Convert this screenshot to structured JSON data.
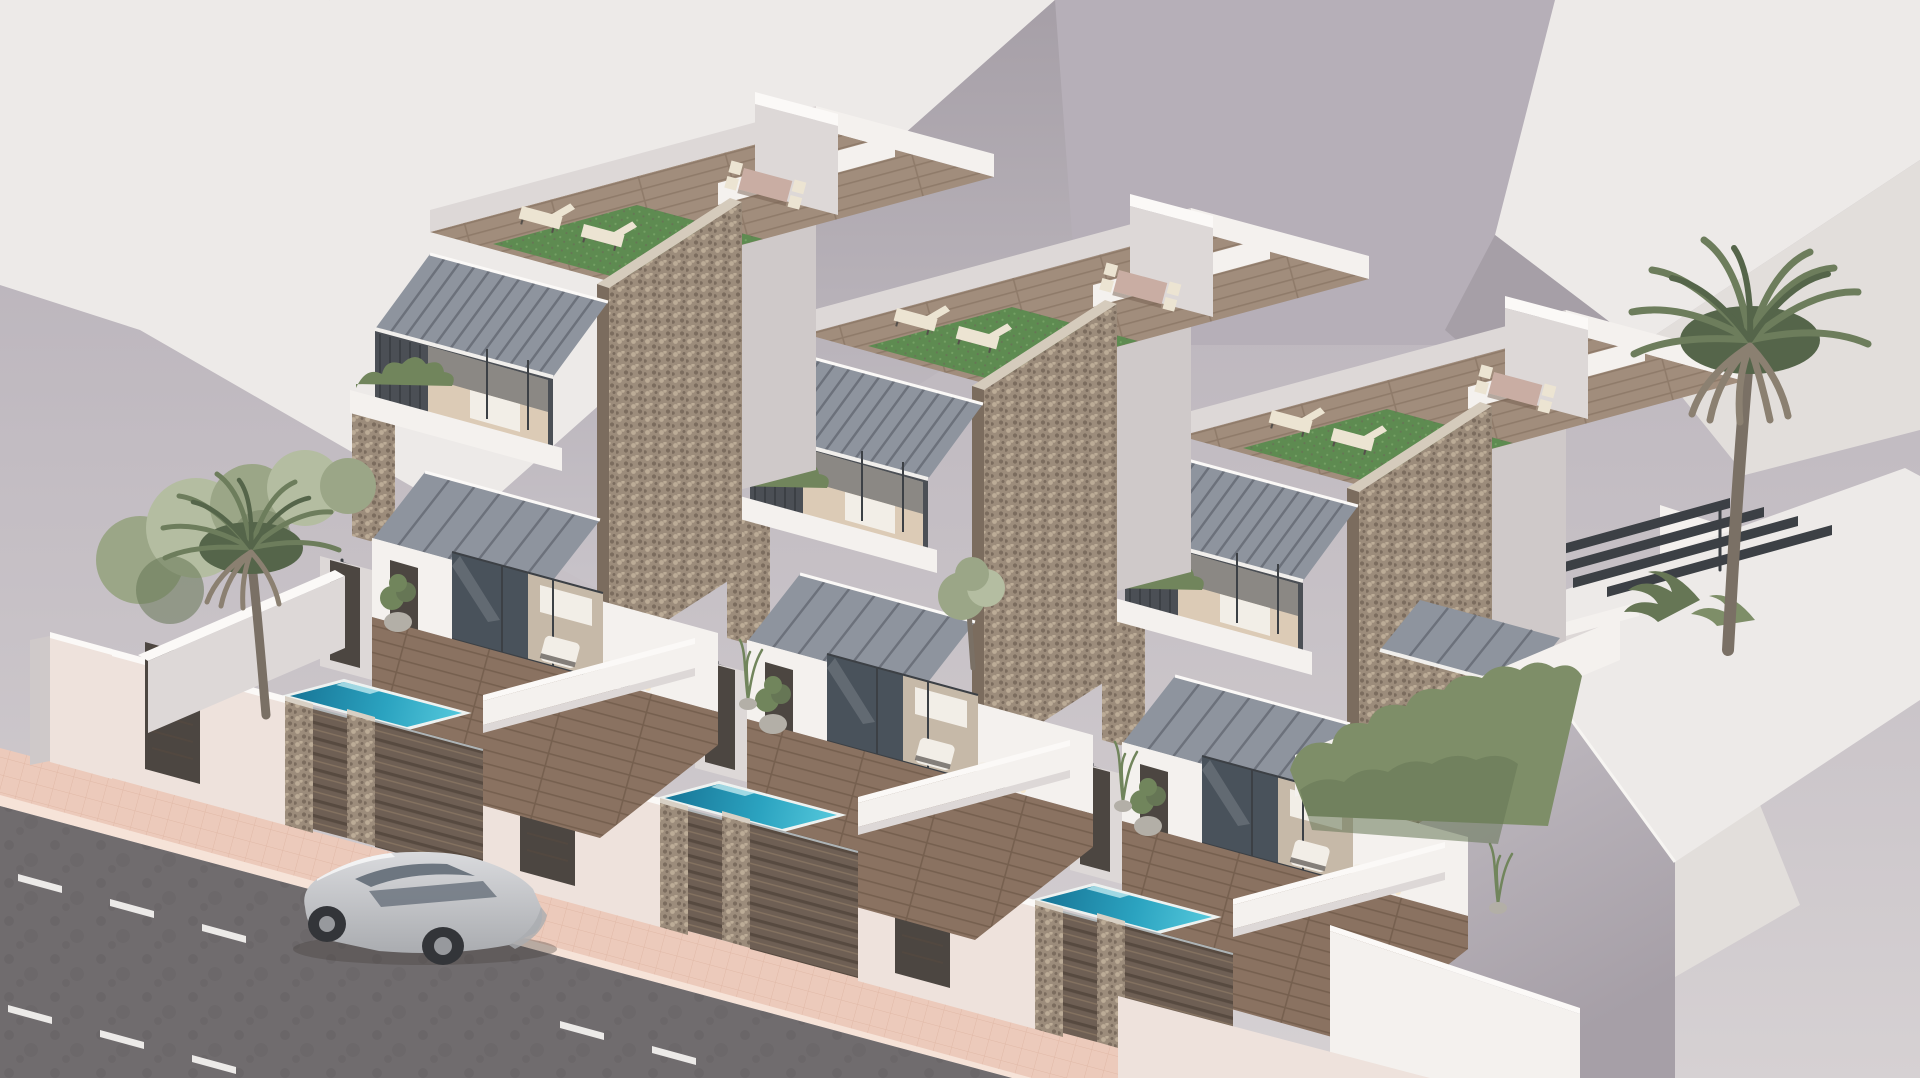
{
  "page": {
    "title": "Architectural 3D render — terrace of three modern villas with private pools"
  },
  "scene": {
    "type": "photorealistic exterior rendering",
    "view": "high-angle three-quarter aerial view",
    "lighting": "soft warm daylight",
    "villas": {
      "count": 3,
      "features": [
        "rooftop solarium with wooden deck and artificial turf",
        "two cream sun loungers per roof",
        "outdoor dining table with four wooden chairs",
        "white stepped parapets and stair bulkhead",
        "gray tiled mono-pitch roofs and door awnings",
        "full-height stone-clad corner pier",
        "recessed balcony with planter and dark glazing",
        "ground floor glass sliding doors with interior glimpse",
        "wooden deck terrace with two white armchairs",
        "turquoise plunge pool with steps",
        "outdoor shower column and potted plants",
        "front fence of dark wood slats between stone pillars",
        "white perimeter walls with dark access gates"
      ]
    },
    "street": {
      "road": "dark asphalt, two dashed white lane lines",
      "sidewalk": "salmon-pink paved tiles with light curb",
      "vehicle": "silver SUV driving along the street"
    },
    "vegetation": [
      "palm tree beside villa one",
      "leafy shrub row behind left boundary wall",
      "tall palm tree at right garden",
      "hedge along right side path",
      "banana plants in right patio",
      "potted olive trees and slim plants"
    ],
    "surroundings": [
      "abstract light-gray neighbouring building masses",
      "large white building block in right foreground",
      "pergola beams and outdoor steps at right villa",
      "white planter walls at lower right"
    ]
  },
  "palette": {
    "bgTop": "#b4adb6",
    "bgBot": "#d6d1d3",
    "bgLightFace": "#edeae8",
    "bgLightFace2": "#e2dedb",
    "bgGrayFace": "#a69fa7",
    "bgGrayFace2": "#b6afb8",
    "bgGrayFace3": "#c8c3c9",
    "white": "#f4f1ee",
    "whiteShade": "#ddd8d7",
    "whiteDim": "#cfc9c9",
    "whitePink": "#eee2dc",
    "cap": "#fbf9f7",
    "recess": "#4b4f55",
    "slatDark": "#3c4045",
    "glass": "#49525b",
    "glassHi": "#8fa0a8",
    "interior": "#dccbb6",
    "interiorFloor": "#b59878",
    "bed": "#f2eee7",
    "stone": "#9c8c7b",
    "stoneHi": "#bcac97",
    "stoneLo": "#7b6c5e",
    "stoneCap": "#d5cbbc",
    "tile": "#8e949e",
    "tileDark": "#6c717b",
    "fascia": "#f1efec",
    "woodRoof": "#a18d7c",
    "woodRoofLine": "#8f7b6a",
    "wood": "#8a7261",
    "woodLine": "#76604f",
    "turf": "#5e8b51",
    "turfHi": "#74a164",
    "poolLight": "#52c6da",
    "poolMid": "#2ba3c0",
    "poolDark": "#19799a",
    "poolRim": "#eef2f0",
    "fence": "#6e5f54",
    "fenceLine": "#574a40",
    "fenceHi": "#847260",
    "rail": "#aeb4b6",
    "gate": "#4c4641",
    "doorGreen": "#3e4a3c",
    "pillarCap": "#d8d0c4",
    "sidewalk": "#eccabb",
    "sidewalkLine": "#d8ab97",
    "curb": "#f6e3d8",
    "road": "#706c6e",
    "roadDark": "#646062",
    "dash": "#eceae8",
    "carBody": "#d9dadd",
    "carShade": "#aaacb0",
    "carGlass": "#6d7680",
    "wheel": "#333539",
    "rim": "#97999d",
    "palm": "#6d7d5c",
    "palmDark": "#55654a",
    "palmSkirt": "#8b8071",
    "trunk": "#7a7065",
    "tree": "#9ba687",
    "treeHi": "#b4bda1",
    "hedge": "#7e8e68",
    "hedgeDark": "#667655",
    "planterGreen": "#71855c",
    "pot": "#b3afa7",
    "glow": "#f6e8cf",
    "shadow": "rgba(70,62,60,0.35)",
    "cream": "#ece4d2",
    "tableWood": "#c9ada3",
    "legs": "#55504b"
  }
}
